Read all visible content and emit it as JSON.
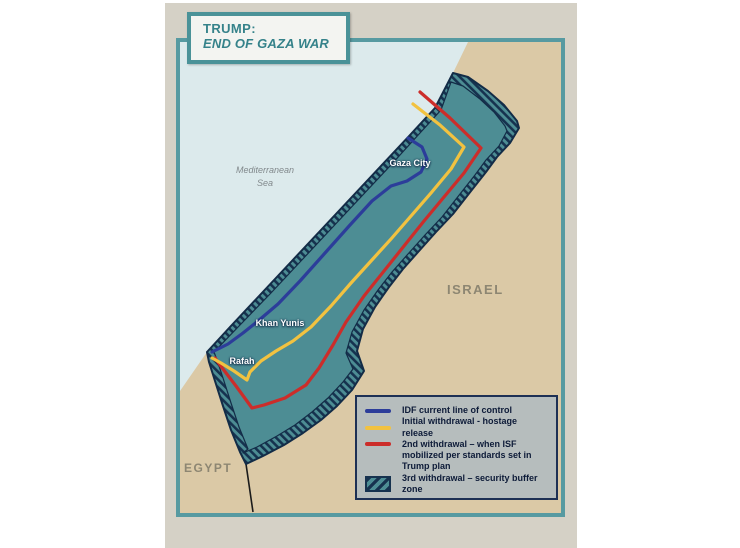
{
  "title_box": {
    "line1": "TRUMP:",
    "line2": "END OF GAZA WAR"
  },
  "map_labels": {
    "sea": "Mediterranean\nSea",
    "israel": "ISRAEL",
    "egypt": "EGYPT",
    "gaza_city": "Gaza City",
    "khan_yunis": "Khan Yunis",
    "rafah": "Rafah"
  },
  "legend": {
    "items": [
      {
        "swatch_type": "line",
        "color": "#2c3d9a",
        "label": "IDF current line of control"
      },
      {
        "swatch_type": "line",
        "color": "#f2c240",
        "label": "Initial withdrawal - hostage release"
      },
      {
        "swatch_type": "line",
        "color": "#cc2d2a",
        "label": "2nd withdrawal – when ISF mobilized per standards set in Trump plan"
      },
      {
        "swatch_type": "hatch",
        "color": "#16324f",
        "label": "3rd withdrawal – security buffer zone"
      }
    ]
  },
  "colors": {
    "idf_line": "#2c3d9a",
    "initial_withdrawal_line": "#f2c240",
    "second_withdrawal_line": "#cc2d2a",
    "buffer_hatch": "#16324f",
    "gaza_fill": "#4d8d94",
    "strip_outline": "#132c47",
    "sea": "#dceaec",
    "land": "#dbc9a6",
    "frame": "#579aa1",
    "slide_bg": "#d5d1c6",
    "legend_bg": "#b6bdbd",
    "title_text": "#35828a",
    "border_line": "#1b1b1b"
  }
}
